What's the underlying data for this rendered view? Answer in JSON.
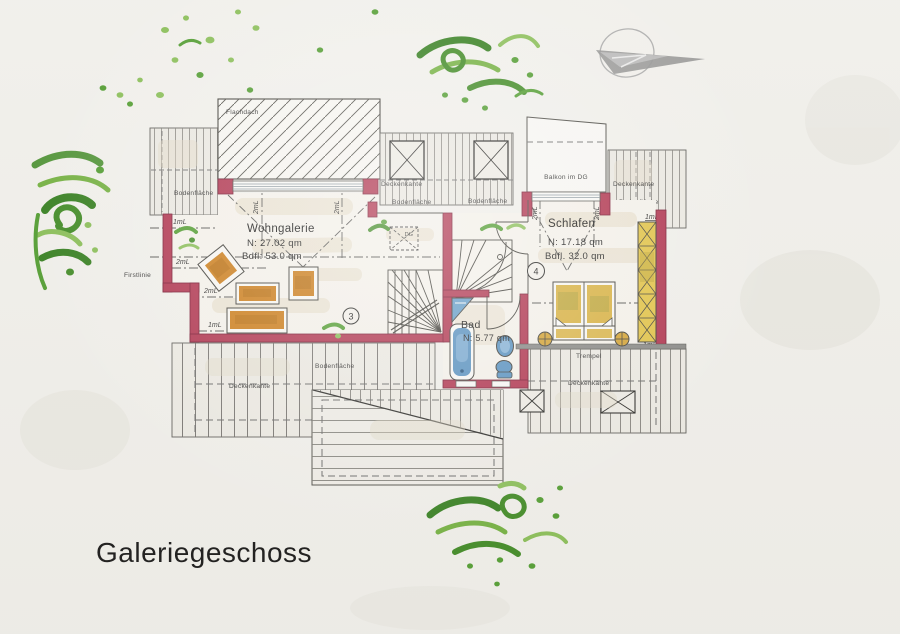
{
  "title": "Galeriegeschoss",
  "rooms": {
    "wohngalerie": {
      "name": "Wohngalerie",
      "area_net": "N: 27.02 qm",
      "area_floor": "Bdfl: 53.0 qm",
      "number": "3"
    },
    "schlafen": {
      "name": "Schlafen",
      "area_net": "N: 17.18 qm",
      "area_floor": "Bdfl. 32.0 qm",
      "number": "4"
    },
    "bad": {
      "name": "Bad",
      "area_net": "N: 5.77 qm"
    }
  },
  "features": {
    "balkon": "Balkon im DG",
    "flachdach": "Flachdach",
    "dg": "DG"
  },
  "annotations": {
    "bodenflaeche": "Bodenfläche",
    "deckenkante": "Deckenkante",
    "firstlinie": "Firstlinie",
    "trempel": "Trempel"
  },
  "heights": {
    "two_m": "2mL",
    "one_m": "1mL"
  },
  "colors": {
    "wall": "#b53b56",
    "furniture_wood": "#d08220",
    "bed": "#d9af35",
    "wardrobe": "#e6c84e",
    "sanitary": "#5e97c6",
    "plants_dark": "#3c8527",
    "plants_light": "#8fc35e",
    "paper": "#f5f4f0",
    "logo_gray": "#9b9b9b"
  }
}
